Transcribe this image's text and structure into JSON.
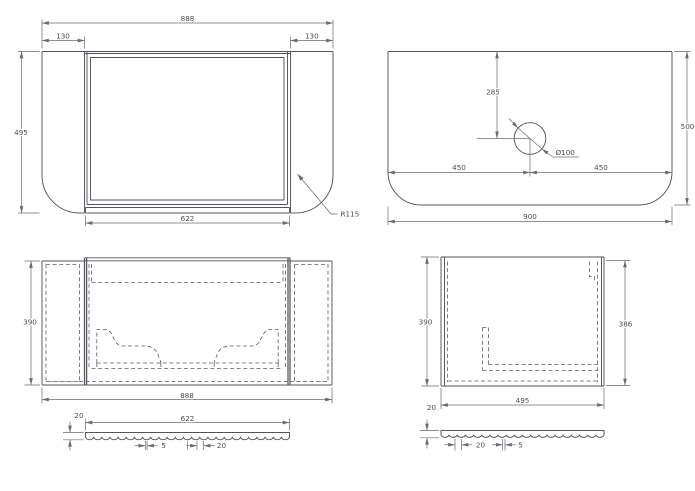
{
  "drawing": {
    "type": "technical-cad-drawing",
    "background": "#ffffff",
    "line_color": "#53555a",
    "dim_line_color": "#6a6b70",
    "text_color": "#4a4c50",
    "views": {
      "front": {
        "overall_width": "888",
        "left_panel_width": "130",
        "right_panel_width": "130",
        "overall_height": "495",
        "door_width": "622",
        "corner_radius": "R115"
      },
      "countertop": {
        "hole_offset_from_back": "285",
        "hole_diameter": "Ø100",
        "hole_center_from_left": "450",
        "hole_center_from_right": "450",
        "overall_width": "900",
        "overall_depth": "500"
      },
      "plan": {
        "overall_depth": "390",
        "overall_width": "888",
        "door_thickness": "20",
        "door_width": "622",
        "flute_flat": "5",
        "flute_width": "20"
      },
      "side": {
        "overall_depth": "390",
        "inner_depth": "386",
        "overall_width": "495",
        "door_thickness": "20",
        "flute_width": "20",
        "flute_flat": "5"
      }
    }
  }
}
